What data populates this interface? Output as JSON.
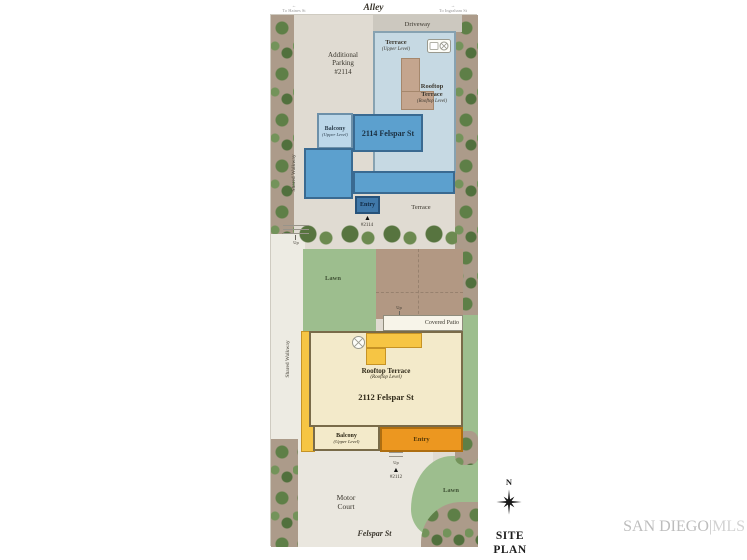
{
  "header": {
    "alley": "Alley",
    "street_left_arrow": "←",
    "street_left": "To Haines St",
    "street_right_arrow": "→",
    "street_right": "To Ingraham St",
    "driveway": "Driveway"
  },
  "upper_lot": {
    "additional_parking": "Additional\nParking\n#2114",
    "terrace_upper": {
      "label": "Terrace",
      "sub": "(Upper Level)"
    },
    "rooftop_terrace": {
      "label": "Rooftop\nTerrace",
      "sub": "(Rooftop Level)"
    },
    "building_name": "2114 Felspar St",
    "balcony": {
      "label": "Balcony",
      "sub": "(Upper Level)"
    },
    "entry": "Entry",
    "entry_marker": "▲",
    "unit_marker": "#2114",
    "ground_terrace": "Terrace",
    "shared_walkway": "Shared Walkway",
    "up": "Up"
  },
  "mid": {
    "lawn": "Lawn",
    "up": "Up",
    "covered_patio": "Covered Patio"
  },
  "lower_lot": {
    "rooftop_terrace": {
      "label": "Rooftop Terrace",
      "sub": "(Rooftop Level)"
    },
    "building_name": "2112 Felspar St",
    "balcony": {
      "label": "Balcony",
      "sub": "(Upper Level)"
    },
    "entry": "Entry",
    "entry_marker": "▲",
    "unit_marker": "#2112",
    "shared_walkway": "Shared Walkway",
    "up": "Up",
    "motor_court": "Motor\nCourt",
    "lawn": "Lawn"
  },
  "footer": {
    "street": "Felspar St"
  },
  "annotations": {
    "compass_n": "N",
    "site_plan": "SITE PLAN"
  },
  "watermark": {
    "primary": "SAN DIEGO",
    "divider": "|",
    "secondary": "MLS"
  },
  "colors": {
    "pavement": "#E0DBD2",
    "driveway": "#CCC8BF",
    "vegetation_ground": "#AC9B8A",
    "tree_green": "#5E7F47",
    "lawn": "#9DBE8E",
    "garden_dirt": "#B29883",
    "building_2114_fill": "#5CA0CE",
    "building_2114_terrace": "#C6D9E3",
    "building_2114_balcony": "#BCD7E9",
    "building_2114_entry": "#4078A9",
    "building_2112_fill": "#F3EACA",
    "building_2112_accent": "#F6C544",
    "building_2112_entry": "#EC9720",
    "watermark_gray": "#C6C6C6"
  }
}
